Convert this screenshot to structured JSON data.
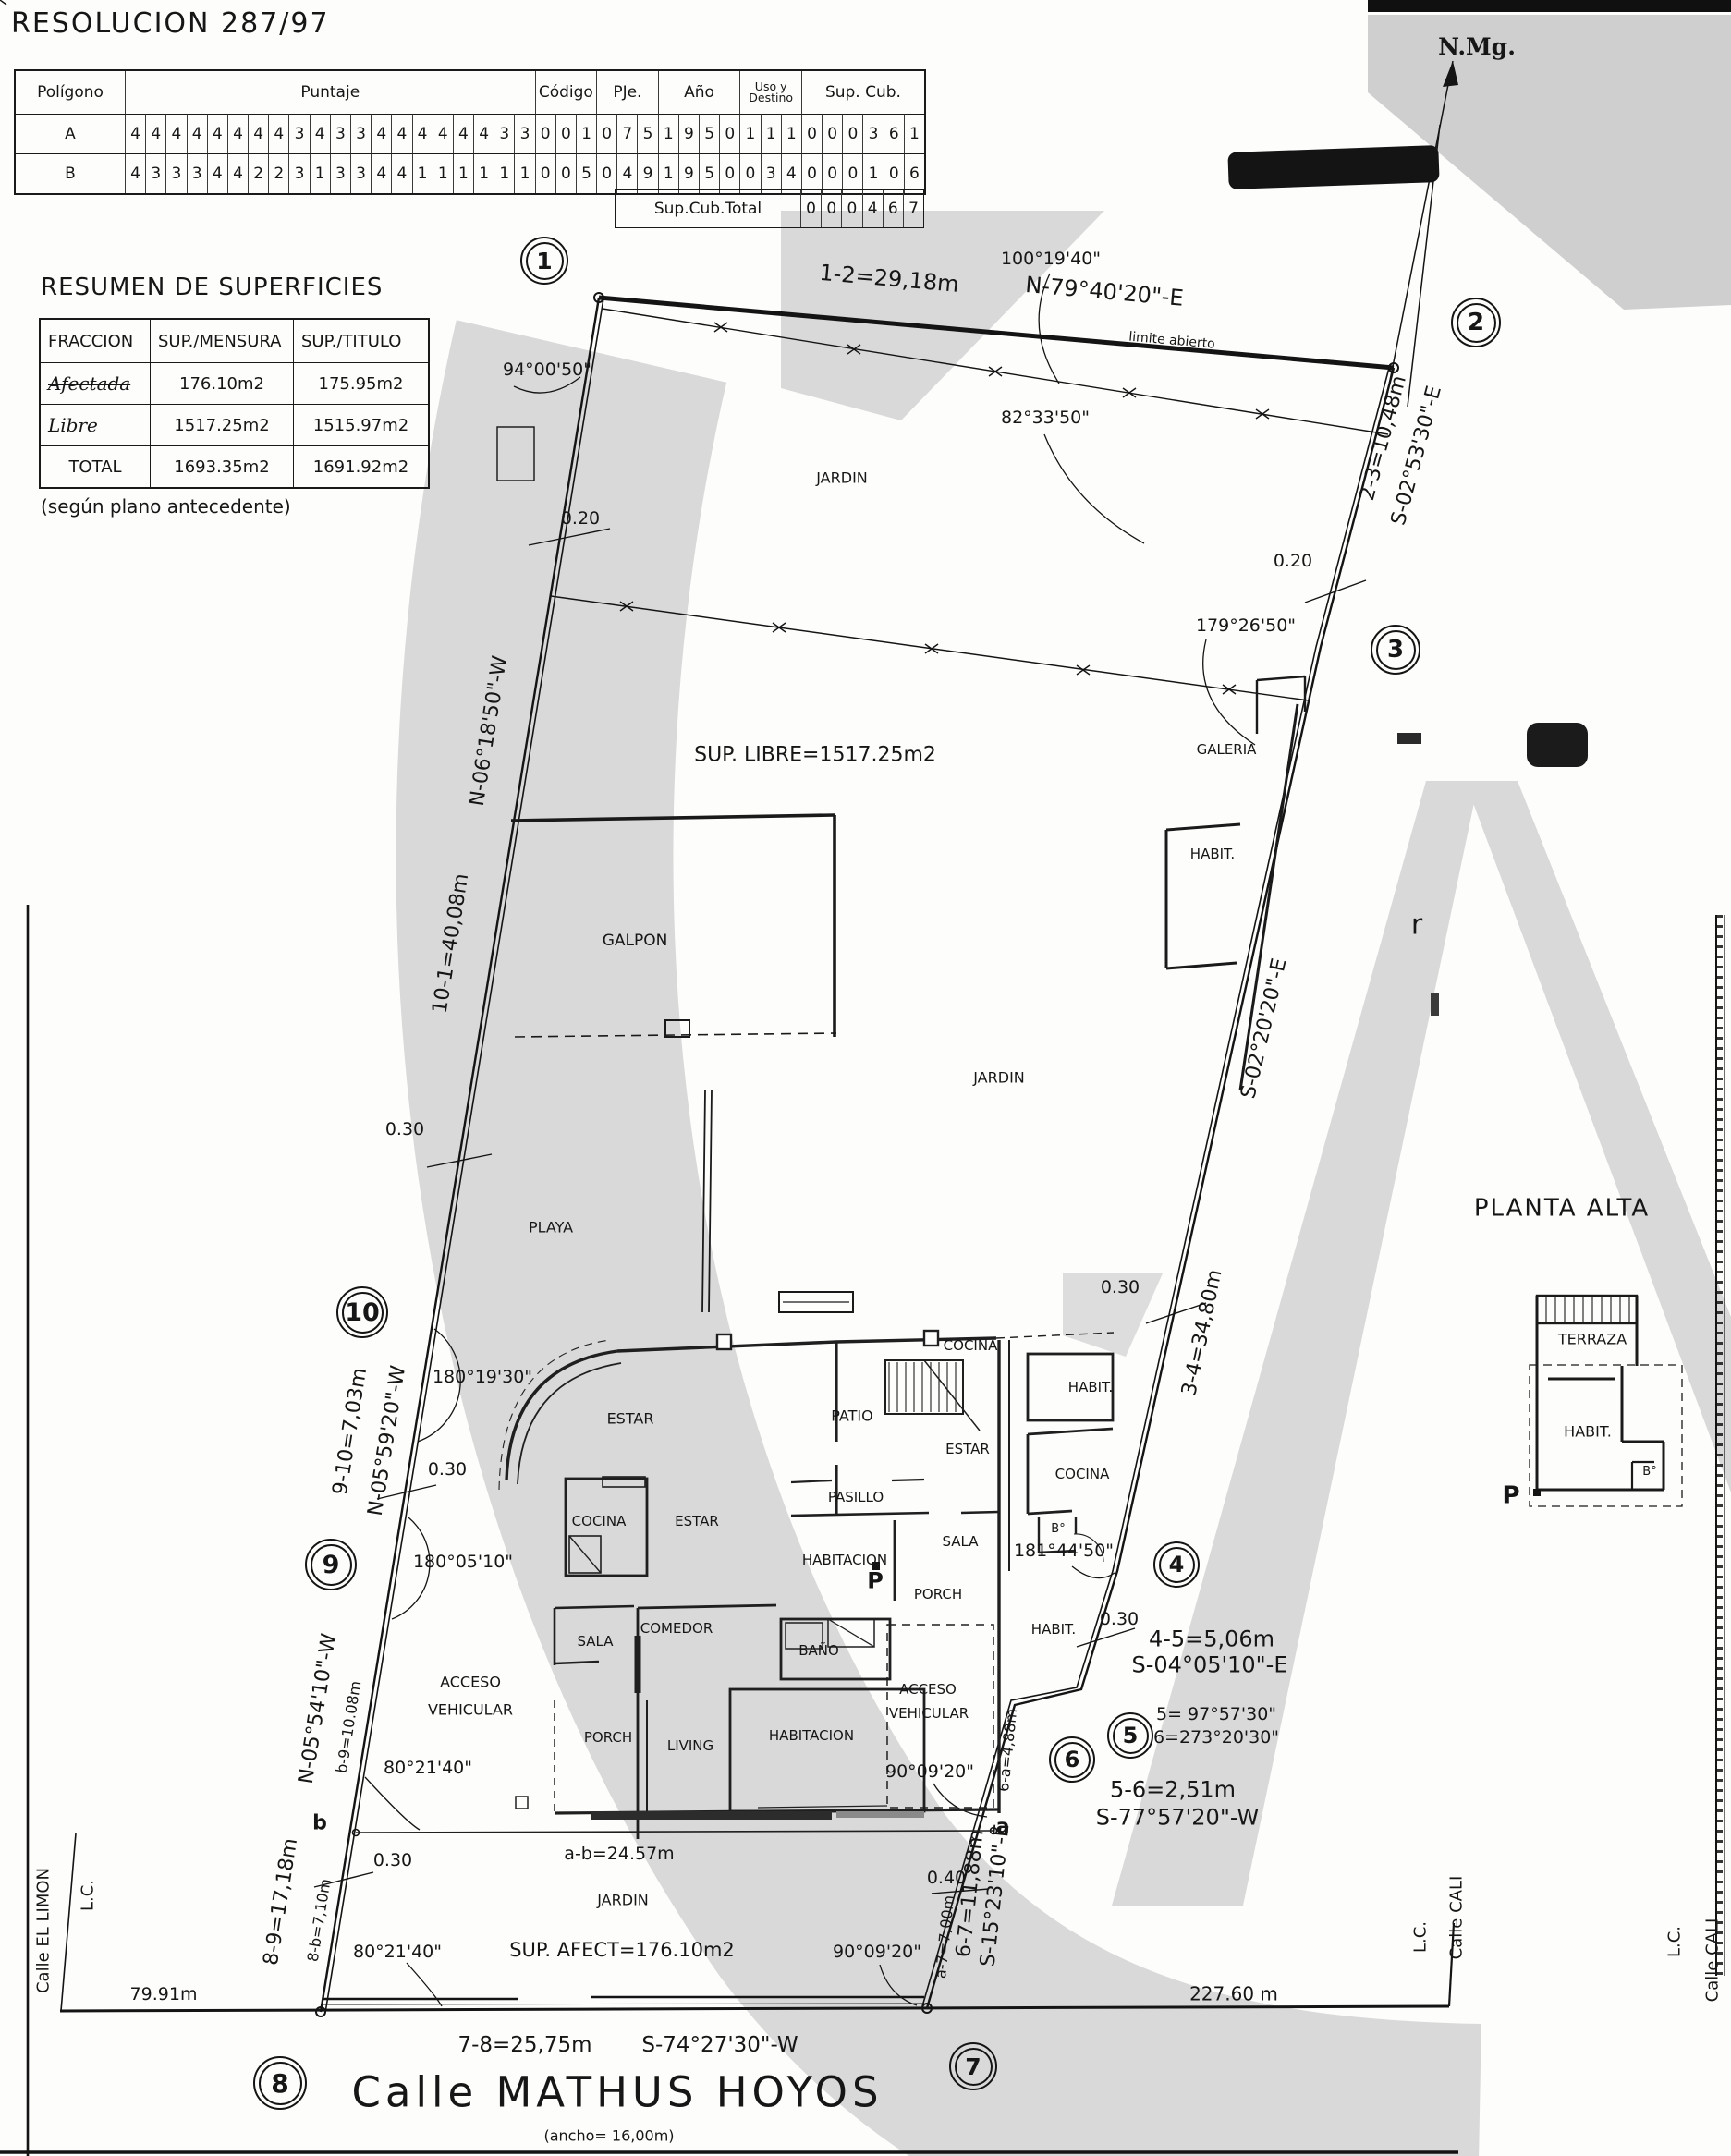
{
  "page": {
    "title": "RESOLUCION 287/97"
  },
  "score_table": {
    "col_poligono": "Polígono",
    "col_puntaje": "Puntaje",
    "col_codigo": "Código",
    "col_pje": "PJe.",
    "col_ano": "Año",
    "col_uso": "Uso y Destino",
    "col_sup": "Sup. Cub.",
    "rows": [
      {
        "poligono": "A",
        "puntaje": "44444444343344444433",
        "codigo": "001",
        "pje": "075",
        "ano": "1950",
        "uso": "111",
        "sup": "000361"
      },
      {
        "poligono": "B",
        "puntaje": "43334422313344111111",
        "codigo": "005",
        "pje": "049",
        "ano": "1950",
        "uso": "034",
        "sup": "000106"
      }
    ],
    "total_label": "Sup.Cub.Total",
    "total": "000467"
  },
  "resumen": {
    "title": "RESUMEN DE SUPERFICIES",
    "headers": [
      "FRACCION",
      "SUP./MENSURA",
      "SUP./TITULO"
    ],
    "rows": [
      [
        "Afectada",
        "176.10m2",
        "175.95m2"
      ],
      [
        "Libre",
        "1517.25m2",
        "1515.97m2"
      ],
      [
        "TOTAL",
        "1693.35m2",
        "1691.92m2"
      ]
    ],
    "note": "(según plano antecedente)"
  },
  "plan": {
    "vertices": [
      "1",
      "2",
      "3",
      "4",
      "5",
      "6",
      "7",
      "8",
      "9",
      "10"
    ],
    "labels": [
      {
        "k": "nmg",
        "t": "N.Mg."
      },
      {
        "k": "ang_94",
        "t": "94°00'50\""
      },
      {
        "k": "dim_1_2",
        "t": "1-2=29,18m"
      },
      {
        "k": "brg_1_2",
        "t": "N-79°40'20\"-E"
      },
      {
        "k": "limite_abierto",
        "t": "limite abierto"
      },
      {
        "k": "ang_100",
        "t": "100°19'40\""
      },
      {
        "k": "ang_82",
        "t": "82°33'50\""
      },
      {
        "k": "dim_2_3",
        "t": "2-3=10,48m"
      },
      {
        "k": "brg_2_3",
        "t": "S-02°53'30\"-E"
      },
      {
        "k": "d020_r",
        "t": "0.20"
      },
      {
        "k": "ang_179",
        "t": "179°26'50\""
      },
      {
        "k": "d020_l",
        "t": "0.20"
      },
      {
        "k": "jardin_top",
        "t": "JARDIN"
      },
      {
        "k": "sup_libre",
        "t": "SUP. LIBRE=1517.25m2"
      },
      {
        "k": "galeria",
        "t": "GALERIA"
      },
      {
        "k": "habit_galeria",
        "t": "HABIT."
      },
      {
        "k": "brg_3_4",
        "t": "S-02°20'20\"-E"
      },
      {
        "k": "dim_3_4",
        "t": "3-4=34,80m"
      },
      {
        "k": "jardin_mid",
        "t": "JARDIN"
      },
      {
        "k": "dim_10_1",
        "t": "10-1=40,08m"
      },
      {
        "k": "brg_10_1",
        "t": "N-06°18'50\"-W"
      },
      {
        "k": "galpon",
        "t": "GALPON"
      },
      {
        "k": "d030_playa",
        "t": "0.30"
      },
      {
        "k": "playa",
        "t": "PLAYA"
      },
      {
        "k": "r_mark",
        "t": "r"
      },
      {
        "k": "dim_9_10",
        "t": "9-10=7,03m"
      },
      {
        "k": "brg_9_10",
        "t": "N-05°59'20\"-W"
      },
      {
        "k": "ang_18019",
        "t": "180°19'30\""
      },
      {
        "k": "d030_910",
        "t": "0.30"
      },
      {
        "k": "ang_18005",
        "t": "180°05'10\""
      },
      {
        "k": "estar_big",
        "t": "ESTAR"
      },
      {
        "k": "cocina_l",
        "t": "COCINA"
      },
      {
        "k": "estar_c",
        "t": "ESTAR"
      },
      {
        "k": "sala_l",
        "t": "SALA"
      },
      {
        "k": "comedor",
        "t": "COMEDOR"
      },
      {
        "k": "porch_l",
        "t": "PORCH"
      },
      {
        "k": "living",
        "t": "LIVING"
      },
      {
        "k": "habitacion_c",
        "t": "HABITACION"
      },
      {
        "k": "bano",
        "t": "BAÑO"
      },
      {
        "k": "cocina_top",
        "t": "COCINA"
      },
      {
        "k": "patio",
        "t": "PATIO"
      },
      {
        "k": "estar_r",
        "t": "ESTAR"
      },
      {
        "k": "pasillo",
        "t": "PASILLO"
      },
      {
        "k": "sala_c",
        "t": "SALA"
      },
      {
        "k": "habitacion_l",
        "t": "HABITACION"
      },
      {
        "k": "p_main",
        "t": "P"
      },
      {
        "k": "porch_r",
        "t": "PORCH"
      },
      {
        "k": "cocina_r",
        "t": "COCINA"
      },
      {
        "k": "habit_r",
        "t": "HABIT."
      },
      {
        "k": "b_main",
        "t": "B°"
      },
      {
        "k": "habit_low",
        "t": "HABIT."
      },
      {
        "k": "ang_181",
        "t": "181°44'50\""
      },
      {
        "k": "d030_34",
        "t": "0.30"
      },
      {
        "k": "d030_45",
        "t": "0.30"
      },
      {
        "k": "dim_4_5",
        "t": "4-5=5,06m"
      },
      {
        "k": "brg_4_5",
        "t": "S-04°05'10\"-E"
      },
      {
        "k": "ang_5",
        "t": "5= 97°57'30\""
      },
      {
        "k": "ang_6",
        "t": "6=273°20'30\""
      },
      {
        "k": "dim_5_6",
        "t": "5-6=2,51m"
      },
      {
        "k": "brg_5_6",
        "t": "S-77°57'20\"-W"
      },
      {
        "k": "acceso_r1",
        "t": "ACCESO"
      },
      {
        "k": "acceso_r2",
        "t": "VEHICULAR"
      },
      {
        "k": "acceso_l1",
        "t": "ACCESO"
      },
      {
        "k": "acceso_l2",
        "t": "VEHICULAR"
      },
      {
        "k": "ang_90u",
        "t": "90°09'20\""
      },
      {
        "k": "dim_6a",
        "t": "6-a=4,88m"
      },
      {
        "k": "a_letter",
        "t": "a"
      },
      {
        "k": "d040",
        "t": "0.40"
      },
      {
        "k": "brg_8_9",
        "t": "N-05°54'10\"-W"
      },
      {
        "k": "dim_b9",
        "t": "b-9=10.08m"
      },
      {
        "k": "ang_80u",
        "t": "80°21'40\""
      },
      {
        "k": "b_letter",
        "t": "b"
      },
      {
        "k": "d030_b",
        "t": "0.30"
      },
      {
        "k": "dim_8b",
        "t": "8-b=7,10m"
      },
      {
        "k": "dim_8_9",
        "t": "8-9=17,18m"
      },
      {
        "k": "ang_80l",
        "t": "80°21'40\""
      },
      {
        "k": "calle_limon",
        "t": "Calle EL LIMON"
      },
      {
        "k": "lc_l",
        "t": "L.C."
      },
      {
        "k": "d7991",
        "t": "79.91m"
      },
      {
        "k": "ab",
        "t": "a-b=24.57m"
      },
      {
        "k": "jardin_bot",
        "t": "JARDIN"
      },
      {
        "k": "sup_afect",
        "t": "SUP. AFECT=176.10m2"
      },
      {
        "k": "ang_90l",
        "t": "90°09'20\""
      },
      {
        "k": "dim_a7",
        "t": "a-7=7,00m"
      },
      {
        "k": "dim_6_7",
        "t": "6-7=11,88m"
      },
      {
        "k": "brg_6_7",
        "t": "S-15°23'10\"-E"
      },
      {
        "k": "d22760",
        "t": "227.60  m"
      },
      {
        "k": "lc_jog",
        "t": "L.C."
      },
      {
        "k": "cali_jog",
        "t": "Calle CALI"
      },
      {
        "k": "lc_r",
        "t": "L.C."
      },
      {
        "k": "cali_r",
        "t": "Calle CALI"
      },
      {
        "k": "dim_7_8",
        "t": "7-8=25,75m"
      },
      {
        "k": "brg_7_8",
        "t": "S-74°27'30\"-W"
      },
      {
        "k": "street",
        "t": "Calle MATHUS HOYOS"
      },
      {
        "k": "ancho",
        "t": "(ancho=  16,00m)"
      },
      {
        "k": "pa_title",
        "t": "PLANTA ALTA"
      },
      {
        "k": "terraza",
        "t": "TERRAZA"
      },
      {
        "k": "habit_pa",
        "t": "HABIT."
      },
      {
        "k": "b_pa",
        "t": "B°"
      },
      {
        "k": "p_pa",
        "t": "P"
      }
    ]
  }
}
